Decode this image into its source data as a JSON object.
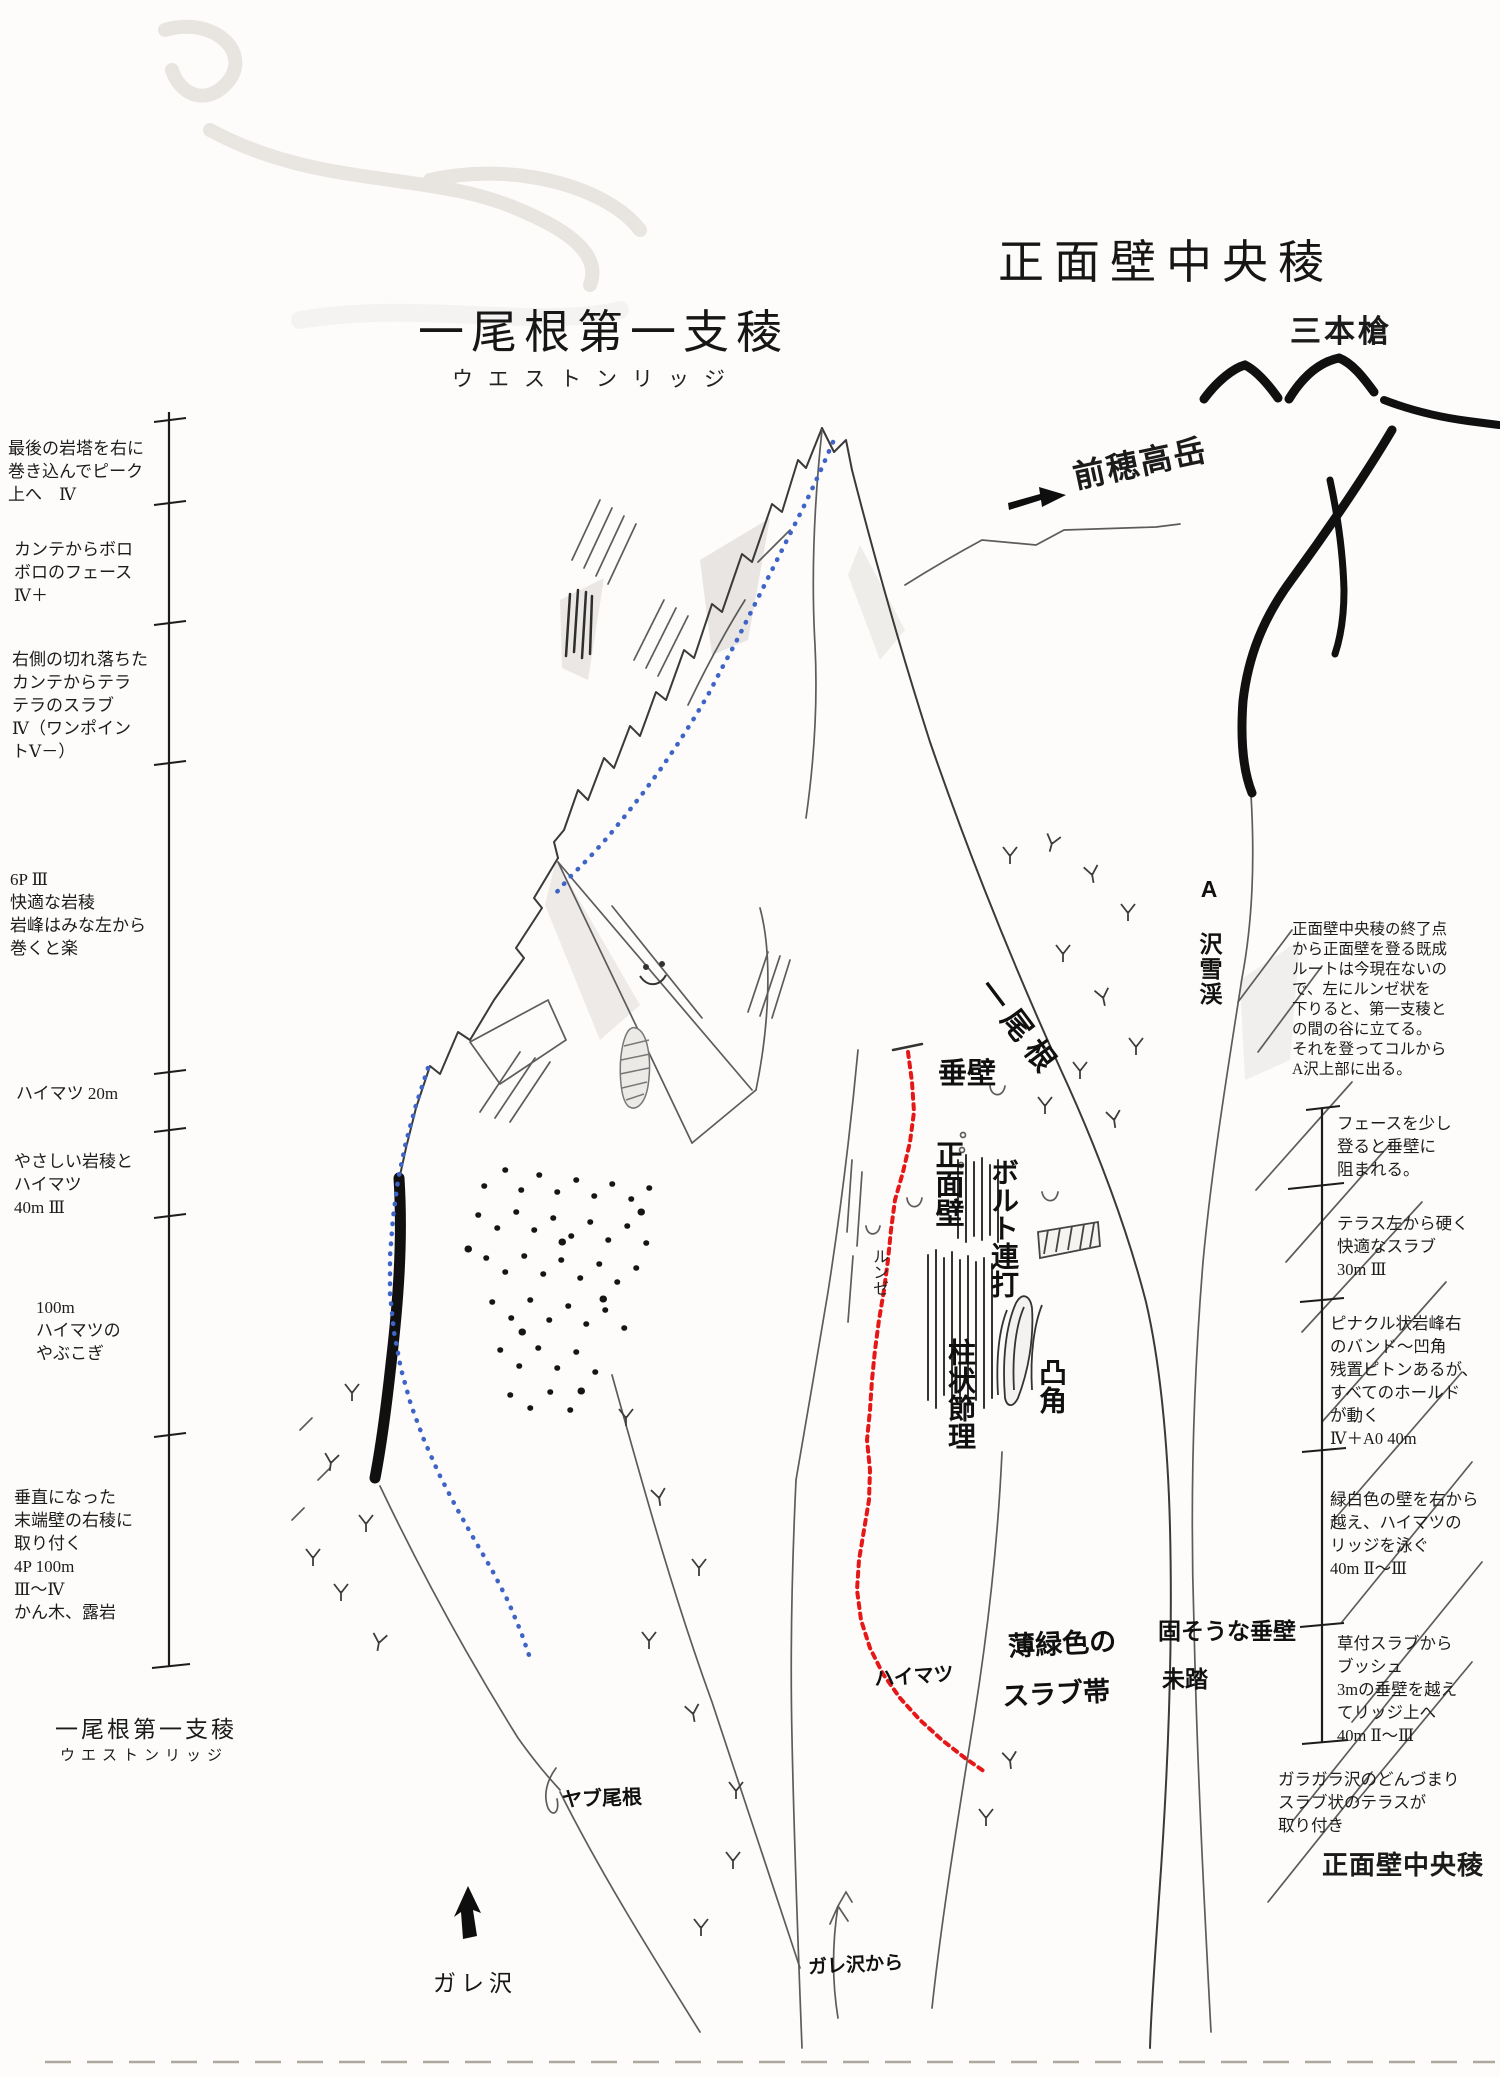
{
  "colors": {
    "paper": "#fdfcfa",
    "ink": "#101010",
    "pencil": "#5c5c5c",
    "route_weston": "#3f64c8",
    "route_front_wall": "#e61717"
  },
  "header": {
    "weston_title": "一尾根第一支稜",
    "weston_subtitle": "ウエストンリッジ",
    "front_wall_title": "正面壁中央稜",
    "three_spears": "三本槍",
    "mae_hotaka": "前穂高岳"
  },
  "left_column": {
    "notes": [
      "最後の岩塔を右に\n巻き込んでピーク\n上へ　Ⅳ",
      "カンテからボロ\nボロのフェース\nⅣ＋",
      "右側の切れ落ちた\nカンテからテラ\nテラのスラブ\nⅣ（ワンポイン\nトⅤ－）",
      "6P Ⅲ\n快適な岩稜\n岩峰はみな左から\n巻くと楽",
      "ハイマツ 20m",
      "やさしい岩稜と\nハイマツ\n40m Ⅲ",
      "100m\nハイマツの\nやぶこぎ",
      "垂直になった\n末端壁の右稜に\n取り付く\n4P 100m\nⅢ～Ⅳ\nかん木、露岩"
    ],
    "footer_title": "一尾根第一支稜",
    "footer_subtitle": "ウエストンリッジ"
  },
  "right_column": {
    "intro": "正面壁中央稜の終了点\nから正面壁を登る既成\nルートは今現在ないの\nで、左にルンゼ状を\n下りると、第一支稜と\nの間の谷に立てる。\nそれを登ってコルから\nA沢上部に出る。",
    "notes": [
      "フェースを少し\n登ると垂壁に\n阻まれる。",
      "テラス左から硬く\n快適なスラブ\n30m Ⅲ",
      "ピナクル状岩峰右\nのバンド～凹角\n残置ピトンあるが、\nすべてのホールド\nが動く\nⅣ＋A0 40m",
      "緑白色の壁を右から\n越え、ハイマツの\nリッジを泳ぐ\n40m Ⅱ～Ⅲ",
      "草付スラブから\nブッシュ\n3mの垂壁を越え\nてリッジ上へ\n40m Ⅱ～Ⅲ",
      "ガラガラ沢のどんづまり\nスラブ状のテラスが\n取り付き"
    ],
    "footer_title": "正面壁中央稜"
  },
  "map_labels": {
    "ridge_one": "一尾根",
    "vertical_wall": "垂壁",
    "front_wall": "正面壁",
    "bolt_ladder": "ボルト連打",
    "runze": "ルンゼ",
    "columnar_joint": "柱状節理",
    "convex_corner": "凸角",
    "a_sawa_snow": "A 沢雪渓",
    "pale_green_1": "薄緑色の",
    "pale_green_2": "スラブ帯",
    "solid_wall": "固そうな垂壁",
    "unclimbed": "未踏",
    "haimatsu": "ハイマツ",
    "yabu_ridge": "ヤブ尾根",
    "gare_sawa": "ガレ沢",
    "gare_sawa_from": "ガレ沢から"
  }
}
